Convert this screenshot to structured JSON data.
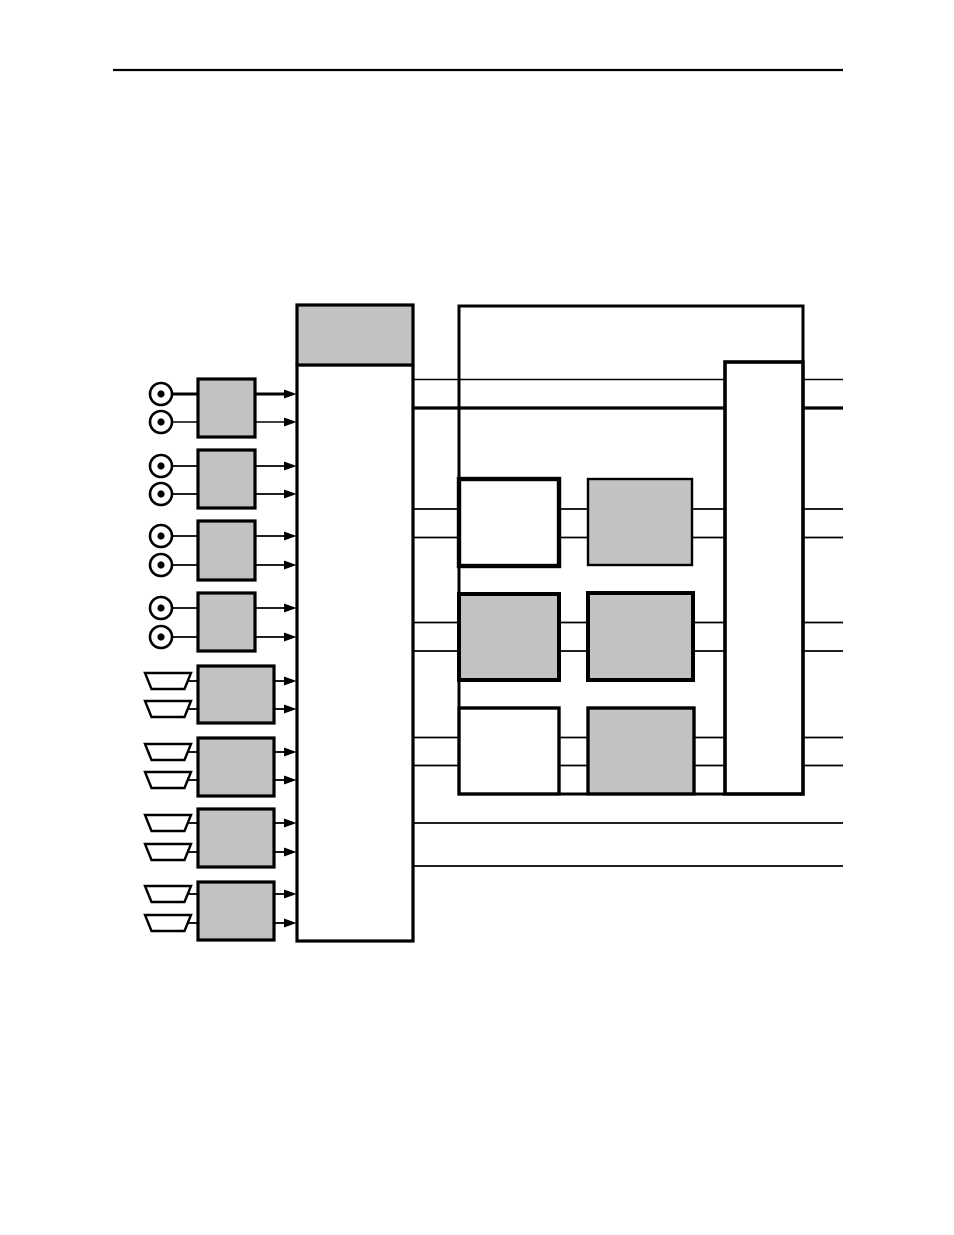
{
  "meta": {
    "kind": "manual-page-figure",
    "description": "Untitled block diagram: eight dual-port input blocks feed a tall selector column which connects through a processing matrix to an output bus; no text labels are rendered on the page"
  },
  "canvas": {
    "width": 954,
    "height": 1235
  },
  "palette": {
    "background": "#ffffff",
    "line": "#000000",
    "block_gray": "#c2c2c2",
    "block_white": "#ffffff"
  },
  "diagram": {
    "header_rule": {
      "x1": 113,
      "x2": 843,
      "y": 70,
      "sw": 2.2
    },
    "blocks": [
      {
        "name": "processing-outer-box",
        "x": 459,
        "y": 306,
        "w": 344,
        "h": 488,
        "fill": "white",
        "sw": 3.0,
        "layer": 0
      },
      {
        "name": "selector-core-block",
        "x": 297,
        "y": 365,
        "w": 116,
        "h": 576,
        "fill": "white",
        "sw": 3.2,
        "layer": 2
      },
      {
        "name": "selector-cap-block",
        "x": 297,
        "y": 305,
        "w": 116,
        "h": 60,
        "fill": "gray",
        "sw": 3.2,
        "layer": 2
      },
      {
        "name": "matrix-row1-left-block",
        "x": 459,
        "y": 479,
        "w": 100,
        "h": 87,
        "fill": "white",
        "sw": 4.4,
        "layer": 2
      },
      {
        "name": "matrix-row1-right-block",
        "x": 588,
        "y": 479,
        "w": 104,
        "h": 86,
        "fill": "gray",
        "sw": 2.4,
        "layer": 2
      },
      {
        "name": "matrix-row2-left-block",
        "x": 459,
        "y": 594,
        "w": 100,
        "h": 86,
        "fill": "gray",
        "sw": 4.0,
        "layer": 2
      },
      {
        "name": "matrix-row2-right-block",
        "x": 588,
        "y": 593,
        "w": 105,
        "h": 87,
        "fill": "gray",
        "sw": 4.0,
        "layer": 2
      },
      {
        "name": "matrix-row3-left-block",
        "x": 459,
        "y": 708,
        "w": 100,
        "h": 86,
        "fill": "white",
        "sw": 3.4,
        "layer": 2
      },
      {
        "name": "matrix-row3-right-block",
        "x": 588,
        "y": 708,
        "w": 106,
        "h": 86,
        "fill": "gray",
        "sw": 3.4,
        "layer": 2
      },
      {
        "name": "output-bus-block",
        "x": 725,
        "y": 362,
        "w": 78,
        "h": 432,
        "fill": "white",
        "sw": 3.6,
        "layer": 3
      }
    ],
    "signal_lines": [
      {
        "name": "bus-line-thin",
        "y": 379.5,
        "x1": 413,
        "x2": 843,
        "sw": 1.4
      },
      {
        "name": "bus-line-thick",
        "y": 408,
        "x1": 413,
        "x2": 843,
        "sw": 3.2
      },
      {
        "name": "row1-line-upper",
        "y": 509,
        "x1": 413,
        "x2": 843,
        "sw": 1.8
      },
      {
        "name": "row1-line-lower",
        "y": 537.5,
        "x1": 413,
        "x2": 843,
        "sw": 1.8
      },
      {
        "name": "row2-line-upper",
        "y": 622.5,
        "x1": 413,
        "x2": 843,
        "sw": 1.8
      },
      {
        "name": "row2-line-lower",
        "y": 651,
        "x1": 413,
        "x2": 843,
        "sw": 1.8
      },
      {
        "name": "row3-line-upper",
        "y": 737.5,
        "x1": 413,
        "x2": 843,
        "sw": 1.8
      },
      {
        "name": "row3-line-lower",
        "y": 765.5,
        "x1": 413,
        "x2": 843,
        "sw": 1.8
      },
      {
        "name": "bottom-line-upper",
        "y": 823,
        "x1": 413,
        "x2": 843,
        "sw": 1.8
      },
      {
        "name": "bottom-line-lower",
        "y": 866,
        "x1": 413,
        "x2": 843,
        "sw": 1.8
      }
    ],
    "input_channels": [
      {
        "name": "input-channel-1",
        "connector": "rca",
        "block": {
          "x": 198,
          "y": 379,
          "w": 57,
          "h": 58
        },
        "ports": [
          {
            "y": 394,
            "sw": 3.0
          },
          {
            "y": 422,
            "sw": 1.6
          }
        ]
      },
      {
        "name": "input-channel-2",
        "connector": "rca",
        "block": {
          "x": 198,
          "y": 450,
          "w": 57,
          "h": 58
        },
        "ports": [
          {
            "y": 466,
            "sw": 1.8
          },
          {
            "y": 494,
            "sw": 1.8
          }
        ]
      },
      {
        "name": "input-channel-3",
        "connector": "rca",
        "block": {
          "x": 198,
          "y": 521,
          "w": 57,
          "h": 59
        },
        "ports": [
          {
            "y": 536,
            "sw": 1.8
          },
          {
            "y": 565,
            "sw": 1.8
          }
        ]
      },
      {
        "name": "input-channel-4",
        "connector": "rca",
        "block": {
          "x": 198,
          "y": 593,
          "w": 57,
          "h": 58
        },
        "ports": [
          {
            "y": 608,
            "sw": 1.8
          },
          {
            "y": 637,
            "sw": 1.8
          }
        ]
      },
      {
        "name": "input-channel-5",
        "connector": "multipin",
        "block": {
          "x": 198,
          "y": 666,
          "w": 76,
          "h": 57
        },
        "ports": [
          {
            "y": 681,
            "sw": 1.8
          },
          {
            "y": 709,
            "sw": 1.8
          }
        ]
      },
      {
        "name": "input-channel-6",
        "connector": "multipin",
        "block": {
          "x": 198,
          "y": 738,
          "w": 76,
          "h": 58
        },
        "ports": [
          {
            "y": 752,
            "sw": 1.8
          },
          {
            "y": 780,
            "sw": 1.8
          }
        ]
      },
      {
        "name": "input-channel-7",
        "connector": "multipin",
        "block": {
          "x": 198,
          "y": 809,
          "w": 76,
          "h": 58
        },
        "ports": [
          {
            "y": 823,
            "sw": 1.8
          },
          {
            "y": 852,
            "sw": 1.8
          }
        ]
      },
      {
        "name": "input-channel-8",
        "connector": "multipin",
        "block": {
          "x": 198,
          "y": 882,
          "w": 76,
          "h": 58
        },
        "ports": [
          {
            "y": 894,
            "sw": 1.8
          },
          {
            "y": 923,
            "sw": 1.8
          }
        ]
      }
    ],
    "connector_styles": {
      "rca": {
        "cx": 161,
        "outer_r": 11,
        "outer_sw": 2.6,
        "dot_r": 3.6,
        "icon": "rca-jack-icon"
      },
      "multipin": {
        "x_left": 145,
        "x_right": 191,
        "inset": 6.5,
        "half_h": 8,
        "sw": 2.4,
        "icon": "multipin-connector-icon"
      }
    },
    "arrow_style": {
      "tip_x": 296.5,
      "head_len": 12.5,
      "head_half_w": 4.5
    }
  }
}
